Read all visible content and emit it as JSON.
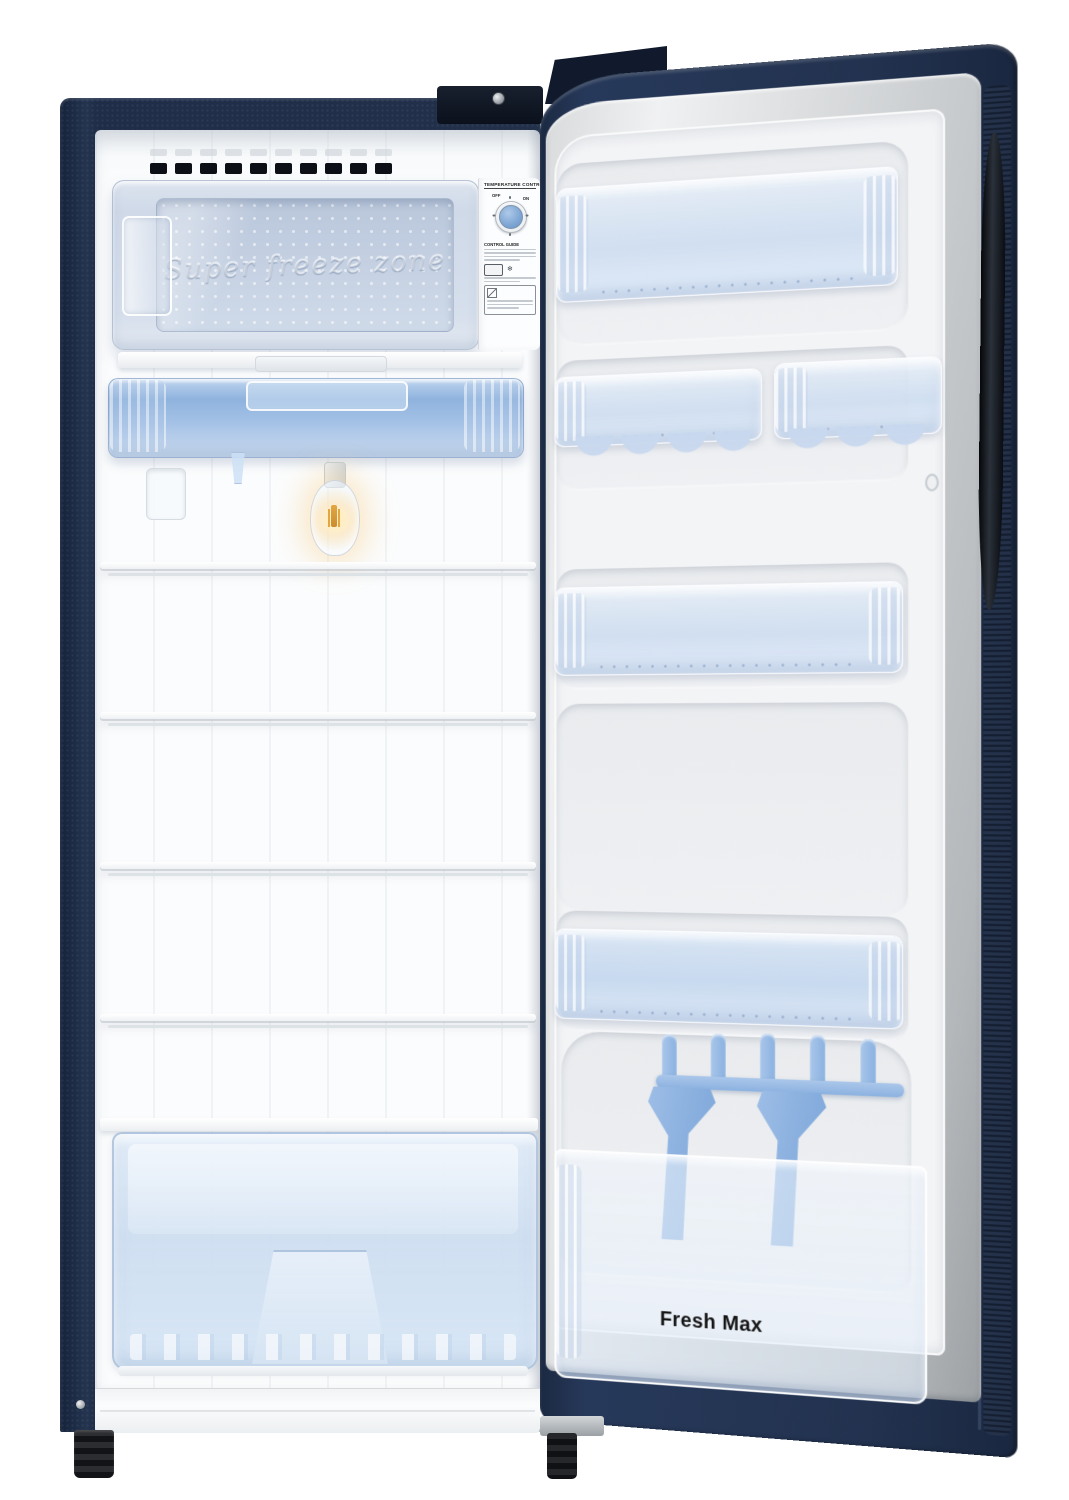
{
  "freezer": {
    "embossed_text": "Super freeze zone"
  },
  "control_panel": {
    "title": "TEMPERATURE CONTROL",
    "dial": {
      "off_label": "OFF",
      "on_label": "ON"
    },
    "guide_title": "CONTROL GUIDE",
    "snowflake_glyph": "❄"
  },
  "door": {
    "bottle_rack_label": "Fresh Max"
  },
  "colors": {
    "cabinet_navy": "#22304a",
    "door_navy": "#22324f",
    "liner_gray": "#cfd2d4",
    "interior_white": "#fbfcfd",
    "freezer_flap_blue": "#cfd9e8",
    "chiller_tray_blue": "#8fb3de",
    "bin_frost_blue": "#cedcf0",
    "divider_blue": "#8cb2e0",
    "knob_blue": "#7ea6d4",
    "bulb_glow": "#f5c87a",
    "leg_black": "#141518"
  }
}
